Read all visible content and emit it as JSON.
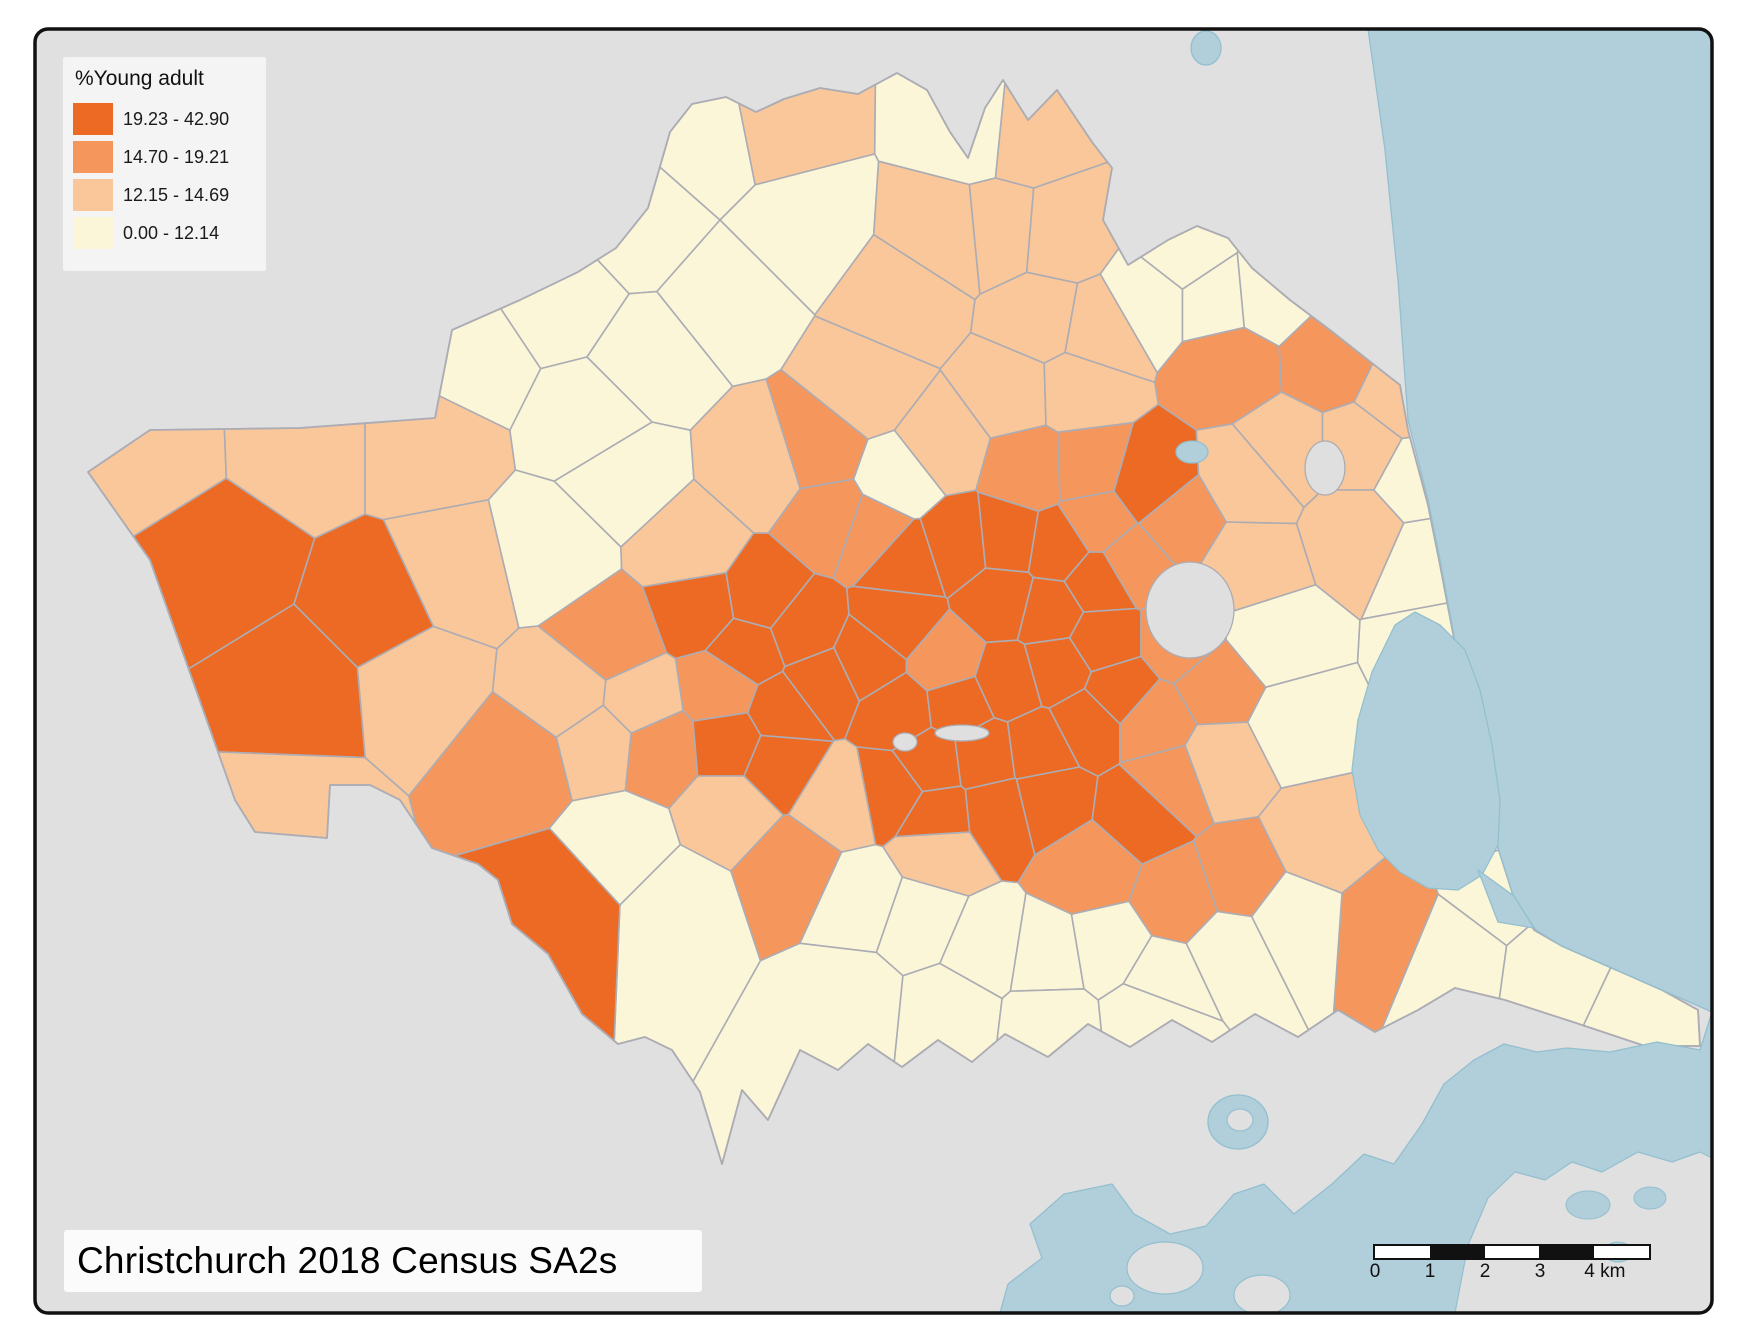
{
  "title": {
    "text": "Christchurch 2018 Census SA2s"
  },
  "legend": {
    "title": "%Young adult",
    "classes": [
      {
        "label": "19.23 - 42.90",
        "color": "#EC6A23"
      },
      {
        "label": "14.70 - 19.21",
        "color": "#F5975D"
      },
      {
        "label": "12.15 - 14.69",
        "color": "#F9C79A"
      },
      {
        "label": "0.00 - 12.14",
        "color": "#FBF6D8"
      }
    ]
  },
  "scalebar": {
    "ticks": [
      "0",
      "1",
      "2",
      "3",
      "4 km"
    ],
    "segments": 5
  },
  "colors": {
    "page": "#FFFFFF",
    "land_outside": "#E0E0E0",
    "water": "#B0CFDA",
    "water_edge": "#93BFCF",
    "boundary": "#ACACB4",
    "frame": "#111111",
    "park": "#DFDFDF"
  },
  "geometry": {
    "frame": {
      "x": 35,
      "y": 29,
      "w": 1677,
      "h": 1284,
      "r": 13
    },
    "footprint": [
      [
        88,
        472
      ],
      [
        150,
        430
      ],
      [
        300,
        428
      ],
      [
        435,
        418
      ],
      [
        452,
        330
      ],
      [
        520,
        300
      ],
      [
        578,
        272
      ],
      [
        616,
        248
      ],
      [
        648,
        208
      ],
      [
        670,
        132
      ],
      [
        692,
        104
      ],
      [
        726,
        97
      ],
      [
        756,
        112
      ],
      [
        784,
        99
      ],
      [
        820,
        88
      ],
      [
        858,
        94
      ],
      [
        897,
        73
      ],
      [
        927,
        90
      ],
      [
        950,
        132
      ],
      [
        968,
        158
      ],
      [
        985,
        108
      ],
      [
        1003,
        80
      ],
      [
        1028,
        120
      ],
      [
        1057,
        90
      ],
      [
        1092,
        142
      ],
      [
        1112,
        168
      ],
      [
        1103,
        220
      ],
      [
        1128,
        265
      ],
      [
        1168,
        240
      ],
      [
        1197,
        226
      ],
      [
        1228,
        238
      ],
      [
        1252,
        268
      ],
      [
        1290,
        300
      ],
      [
        1330,
        330
      ],
      [
        1368,
        360
      ],
      [
        1400,
        385
      ],
      [
        1408,
        430
      ],
      [
        1428,
        505
      ],
      [
        1440,
        565
      ],
      [
        1452,
        628
      ],
      [
        1465,
        695
      ],
      [
        1478,
        760
      ],
      [
        1494,
        835
      ],
      [
        1514,
        898
      ],
      [
        1534,
        930
      ],
      [
        1562,
        946
      ],
      [
        1612,
        968
      ],
      [
        1662,
        990
      ],
      [
        1698,
        1010
      ],
      [
        1700,
        1046
      ],
      [
        1645,
        1046
      ],
      [
        1573,
        1022
      ],
      [
        1505,
        1000
      ],
      [
        1455,
        988
      ],
      [
        1418,
        1010
      ],
      [
        1375,
        1032
      ],
      [
        1338,
        1010
      ],
      [
        1298,
        1037
      ],
      [
        1255,
        1014
      ],
      [
        1212,
        1042
      ],
      [
        1172,
        1020
      ],
      [
        1130,
        1047
      ],
      [
        1088,
        1024
      ],
      [
        1048,
        1057
      ],
      [
        1005,
        1034
      ],
      [
        972,
        1062
      ],
      [
        938,
        1040
      ],
      [
        902,
        1067
      ],
      [
        868,
        1044
      ],
      [
        838,
        1070
      ],
      [
        800,
        1050
      ],
      [
        768,
        1120
      ],
      [
        742,
        1090
      ],
      [
        722,
        1164
      ],
      [
        700,
        1092
      ],
      [
        672,
        1050
      ],
      [
        645,
        1037
      ],
      [
        618,
        1044
      ],
      [
        582,
        1014
      ],
      [
        548,
        954
      ],
      [
        512,
        924
      ],
      [
        498,
        880
      ],
      [
        478,
        864
      ],
      [
        432,
        848
      ],
      [
        400,
        800
      ],
      [
        370,
        785
      ],
      [
        330,
        785
      ],
      [
        327,
        838
      ],
      [
        255,
        832
      ],
      [
        235,
        800
      ],
      [
        150,
        560
      ]
    ],
    "seeds": [
      [
        220,
        560,
        0
      ],
      [
        300,
        690,
        0
      ],
      [
        380,
        610,
        0
      ],
      [
        150,
        448,
        2
      ],
      [
        300,
        442,
        2
      ],
      [
        430,
        442,
        2
      ],
      [
        295,
        820,
        2
      ],
      [
        470,
        360,
        3
      ],
      [
        560,
        300,
        3
      ],
      [
        640,
        225,
        3
      ],
      [
        715,
        140,
        3
      ],
      [
        775,
        128,
        2
      ],
      [
        800,
        225,
        3
      ],
      [
        725,
        300,
        3
      ],
      [
        650,
        360,
        3
      ],
      [
        590,
        420,
        3
      ],
      [
        625,
        478,
        3
      ],
      [
        552,
        552,
        3
      ],
      [
        690,
        548,
        2
      ],
      [
        455,
        575,
        2
      ],
      [
        418,
        680,
        2
      ],
      [
        520,
        762,
        1
      ],
      [
        568,
        695,
        2
      ],
      [
        612,
        640,
        1
      ],
      [
        700,
        608,
        0
      ],
      [
        748,
        650,
        0
      ],
      [
        722,
        690,
        1
      ],
      [
        640,
        702,
        2
      ],
      [
        600,
        742,
        2
      ],
      [
        660,
        748,
        1
      ],
      [
        730,
        742,
        0
      ],
      [
        782,
        712,
        0
      ],
      [
        778,
        762,
        0
      ],
      [
        822,
        682,
        0
      ],
      [
        802,
        630,
        0
      ],
      [
        762,
        598,
        0
      ],
      [
        945,
        662,
        1
      ],
      [
        832,
        518,
        1
      ],
      [
        872,
        532,
        1
      ],
      [
        905,
        562,
        0
      ],
      [
        958,
        545,
        0
      ],
      [
        1008,
        540,
        0
      ],
      [
        1058,
        548,
        0
      ],
      [
        898,
        622,
        0
      ],
      [
        1002,
        600,
        0
      ],
      [
        1050,
        612,
        0
      ],
      [
        1098,
        582,
        0
      ],
      [
        958,
        705,
        0
      ],
      [
        1008,
        682,
        0
      ],
      [
        1058,
        668,
        0
      ],
      [
        1102,
        640,
        0
      ],
      [
        900,
        712,
        0
      ],
      [
        868,
        660,
        0
      ],
      [
        930,
        762,
        0
      ],
      [
        985,
        755,
        0
      ],
      [
        1038,
        748,
        0
      ],
      [
        1088,
        722,
        0
      ],
      [
        938,
        818,
        0
      ],
      [
        998,
        812,
        0
      ],
      [
        1048,
        800,
        0
      ],
      [
        892,
        790,
        0
      ],
      [
        1098,
        522,
        1
      ],
      [
        762,
        468,
        2
      ],
      [
        820,
        450,
        1
      ],
      [
        898,
        478,
        3
      ],
      [
        940,
        445,
        2
      ],
      [
        1030,
        470,
        1
      ],
      [
        1088,
        468,
        1
      ],
      [
        1148,
        485,
        0
      ],
      [
        1178,
        522,
        1
      ],
      [
        1132,
        562,
        1
      ],
      [
        868,
        390,
        2
      ],
      [
        1012,
        392,
        2
      ],
      [
        1078,
        390,
        2
      ],
      [
        905,
        302,
        2
      ],
      [
        948,
        235,
        2
      ],
      [
        1025,
        135,
        2
      ],
      [
        975,
        130,
        3
      ],
      [
        1000,
        230,
        2
      ],
      [
        1060,
        235,
        2
      ],
      [
        1042,
        320,
        2
      ],
      [
        1098,
        330,
        2
      ],
      [
        1150,
        300,
        3
      ],
      [
        1185,
        255,
        3
      ],
      [
        1215,
        300,
        3
      ],
      [
        1230,
        365,
        1
      ],
      [
        1268,
        295,
        3
      ],
      [
        1330,
        360,
        1
      ],
      [
        1285,
        450,
        2
      ],
      [
        1360,
        450,
        2
      ],
      [
        1250,
        480,
        2
      ],
      [
        1402,
        395,
        2
      ],
      [
        1360,
        530,
        2
      ],
      [
        1415,
        480,
        3
      ],
      [
        1428,
        560,
        3
      ],
      [
        1445,
        650,
        3
      ],
      [
        1458,
        740,
        3
      ],
      [
        1472,
        820,
        3
      ],
      [
        1495,
        890,
        3
      ],
      [
        1272,
        640,
        3
      ],
      [
        1295,
        725,
        3
      ],
      [
        1248,
        565,
        2
      ],
      [
        1180,
        640,
        1
      ],
      [
        1218,
        685,
        1
      ],
      [
        1152,
        722,
        1
      ],
      [
        1118,
        692,
        0
      ],
      [
        1168,
        782,
        1
      ],
      [
        1140,
        812,
        0
      ],
      [
        1222,
        762,
        2
      ],
      [
        1320,
        840,
        2
      ],
      [
        1240,
        880,
        1
      ],
      [
        1180,
        900,
        1
      ],
      [
        1390,
        925,
        1
      ],
      [
        1450,
        950,
        3
      ],
      [
        1560,
        965,
        3
      ],
      [
        1645,
        1005,
        3
      ],
      [
        620,
        845,
        3
      ],
      [
        680,
        905,
        3
      ],
      [
        560,
        900,
        0
      ],
      [
        730,
        810,
        2
      ],
      [
        792,
        868,
        1
      ],
      [
        840,
        800,
        2
      ],
      [
        940,
        850,
        2
      ],
      [
        1090,
        868,
        1
      ],
      [
        862,
        900,
        3
      ],
      [
        920,
        920,
        3
      ],
      [
        985,
        948,
        3
      ],
      [
        1048,
        958,
        3
      ],
      [
        1108,
        948,
        3
      ],
      [
        1162,
        980,
        3
      ],
      [
        1230,
        948,
        3
      ],
      [
        1290,
        918,
        3
      ],
      [
        850,
        1000,
        3
      ],
      [
        950,
        1010,
        3
      ],
      [
        1050,
        1022,
        3
      ],
      [
        1150,
        1012,
        3
      ]
    ],
    "ocean": [
      [
        1368,
        29
      ],
      [
        1385,
        150
      ],
      [
        1398,
        280
      ],
      [
        1408,
        420
      ],
      [
        1428,
        500
      ],
      [
        1440,
        560
      ],
      [
        1452,
        625
      ],
      [
        1465,
        695
      ],
      [
        1478,
        760
      ],
      [
        1494,
        835
      ],
      [
        1514,
        898
      ],
      [
        1536,
        930
      ],
      [
        1562,
        946
      ],
      [
        1612,
        968
      ],
      [
        1662,
        990
      ],
      [
        1712,
        1012
      ],
      [
        1712,
        29
      ]
    ],
    "harbour": [
      [
        1712,
        1012
      ],
      [
        1700,
        1050
      ],
      [
        1657,
        1042
      ],
      [
        1610,
        1052
      ],
      [
        1567,
        1048
      ],
      [
        1537,
        1052
      ],
      [
        1504,
        1044
      ],
      [
        1474,
        1060
      ],
      [
        1444,
        1084
      ],
      [
        1422,
        1124
      ],
      [
        1394,
        1164
      ],
      [
        1364,
        1154
      ],
      [
        1332,
        1184
      ],
      [
        1294,
        1214
      ],
      [
        1264,
        1184
      ],
      [
        1234,
        1194
      ],
      [
        1206,
        1226
      ],
      [
        1170,
        1234
      ],
      [
        1134,
        1214
      ],
      [
        1112,
        1184
      ],
      [
        1064,
        1194
      ],
      [
        1030,
        1224
      ],
      [
        1042,
        1258
      ],
      [
        1008,
        1284
      ],
      [
        1000,
        1313
      ],
      [
        1712,
        1313
      ]
    ],
    "estuary": [
      [
        1395,
        625
      ],
      [
        1372,
        672
      ],
      [
        1358,
        720
      ],
      [
        1352,
        770
      ],
      [
        1360,
        815
      ],
      [
        1378,
        850
      ],
      [
        1400,
        872
      ],
      [
        1428,
        888
      ],
      [
        1458,
        890
      ],
      [
        1482,
        875
      ],
      [
        1498,
        845
      ],
      [
        1500,
        800
      ],
      [
        1492,
        745
      ],
      [
        1480,
        690
      ],
      [
        1465,
        650
      ],
      [
        1440,
        625
      ],
      [
        1415,
        612
      ]
    ],
    "channel": [
      [
        1478,
        870
      ],
      [
        1514,
        896
      ],
      [
        1534,
        928
      ],
      [
        1498,
        922
      ]
    ],
    "bay": {
      "cx": 1238,
      "cy": 1122,
      "rx": 30,
      "ry": 27
    },
    "lakes": [
      {
        "cx": 1206,
        "cy": 48,
        "rx": 15,
        "ry": 17
      },
      {
        "cx": 1192,
        "cy": 452,
        "rx": 16,
        "ry": 11
      }
    ],
    "parks": [
      {
        "cx": 1190,
        "cy": 610,
        "rx": 44,
        "ry": 48
      },
      {
        "cx": 1325,
        "cy": 468,
        "rx": 20,
        "ry": 27
      },
      {
        "cx": 962,
        "cy": 733,
        "rx": 27,
        "ry": 8
      },
      {
        "cx": 905,
        "cy": 742,
        "rx": 12,
        "ry": 9
      }
    ],
    "islands": [
      {
        "cx": 1165,
        "cy": 1268,
        "rx": 38,
        "ry": 26
      },
      {
        "cx": 1262,
        "cy": 1295,
        "rx": 28,
        "ry": 20
      },
      {
        "cx": 1122,
        "cy": 1296,
        "rx": 12,
        "ry": 10
      },
      {
        "cx": 1240,
        "cy": 1120,
        "rx": 13,
        "ry": 11
      }
    ],
    "peninsula": [
      [
        1455,
        1313
      ],
      [
        1468,
        1245
      ],
      [
        1488,
        1198
      ],
      [
        1515,
        1172
      ],
      [
        1545,
        1180
      ],
      [
        1572,
        1162
      ],
      [
        1602,
        1172
      ],
      [
        1638,
        1152
      ],
      [
        1672,
        1162
      ],
      [
        1700,
        1152
      ],
      [
        1712,
        1158
      ],
      [
        1712,
        1313
      ]
    ],
    "peninsula_lakes": [
      {
        "cx": 1588,
        "cy": 1205,
        "rx": 22,
        "ry": 14
      },
      {
        "cx": 1650,
        "cy": 1198,
        "rx": 16,
        "ry": 11
      },
      {
        "cx": 1618,
        "cy": 1252,
        "rx": 14,
        "ry": 10
      }
    ]
  }
}
